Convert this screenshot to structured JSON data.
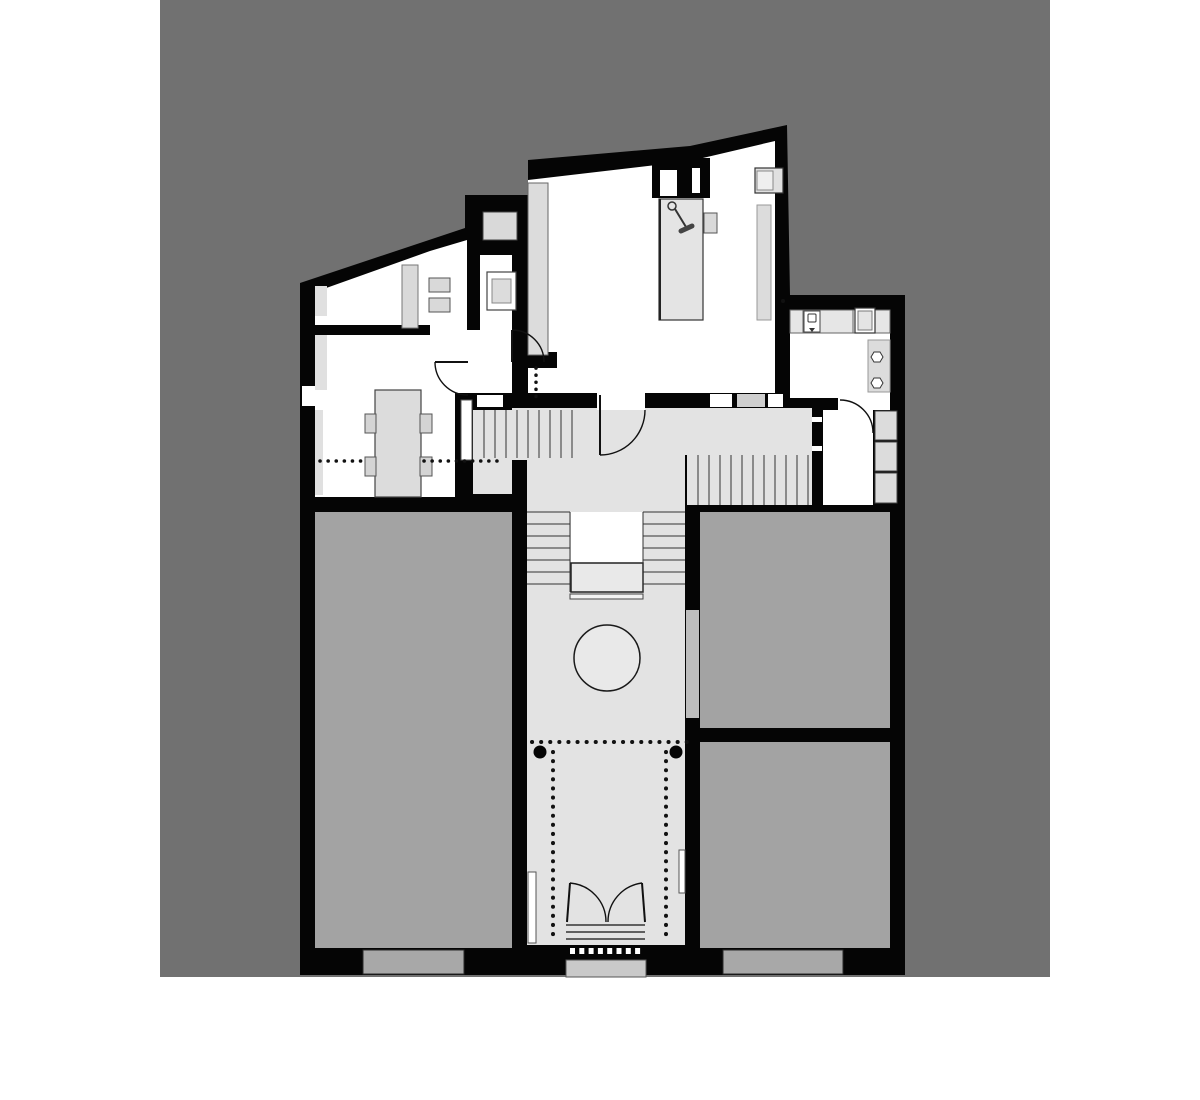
{
  "meta": {
    "kind": "architectural floor plan, presentation drawing",
    "text_on_image": ""
  },
  "palette": {
    "page_bg": "#ffffff",
    "canvas_bg": "#717171",
    "wall": "#050505",
    "room_white": "#ffffff",
    "hall_floor": "#e3e3e3",
    "gray_room": "#a3a3a3",
    "furniture": "#dcdcdc",
    "furniture_light": "#e4e4e4",
    "window_sill": "#a8a8a8",
    "entry_step": "#c9c9c9",
    "wall_niche": "#bdbdbd",
    "landing": "#e9e9e9",
    "line": "#1a1a1a"
  },
  "features": {
    "round_table_count": 1,
    "column_count": 2,
    "stair_run_count": 4,
    "door_swing_count": 7,
    "entry_double_door_count": 1,
    "gray_room_count": 3,
    "bottom_window_count": 2
  }
}
